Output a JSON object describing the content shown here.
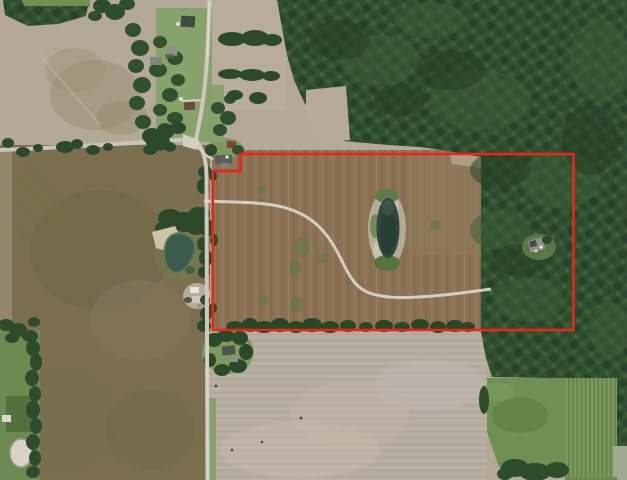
{
  "meta": {
    "view_type": "satellite-aerial-map",
    "image_width": 627,
    "image_height": 480,
    "visible_text": "none"
  },
  "parcel_boundary": {
    "label": "outlined-property-parcel",
    "stroke_color": "#ee2419",
    "stroke_width": "2.6",
    "points": "240.5,154 573.5,154 573.5,330 212.7,330 212.7,171 240.5,171"
  },
  "features": {
    "woodland_areas": [
      "north-east-forest",
      "parcel-east-forest",
      "south-east-forest-band",
      "top-left-tree-grove"
    ],
    "fields": {
      "north_west_field": "#b3a996",
      "parcel_interior_tilled": "#8b7254",
      "south_west_olive_field": "#7b6f4f",
      "south_central_tilled": "#b6aea1",
      "meadow": "#6f9053",
      "vineyard_rows": "#7a985c"
    },
    "water": {
      "west_pond": "#3c5a4e",
      "parcel_pond": "#2f473d",
      "small_white_pond": "#d8d3c6"
    },
    "roads": {
      "surface_color": "#cdc9be",
      "north_south_road": true,
      "east_west_road": true,
      "parcel_driveway_lane": true
    },
    "structures": [
      "roadside-farmhouses",
      "notch-house",
      "west-farmstead-buildings",
      "forest-clearing-house",
      "south-trees-house"
    ]
  }
}
